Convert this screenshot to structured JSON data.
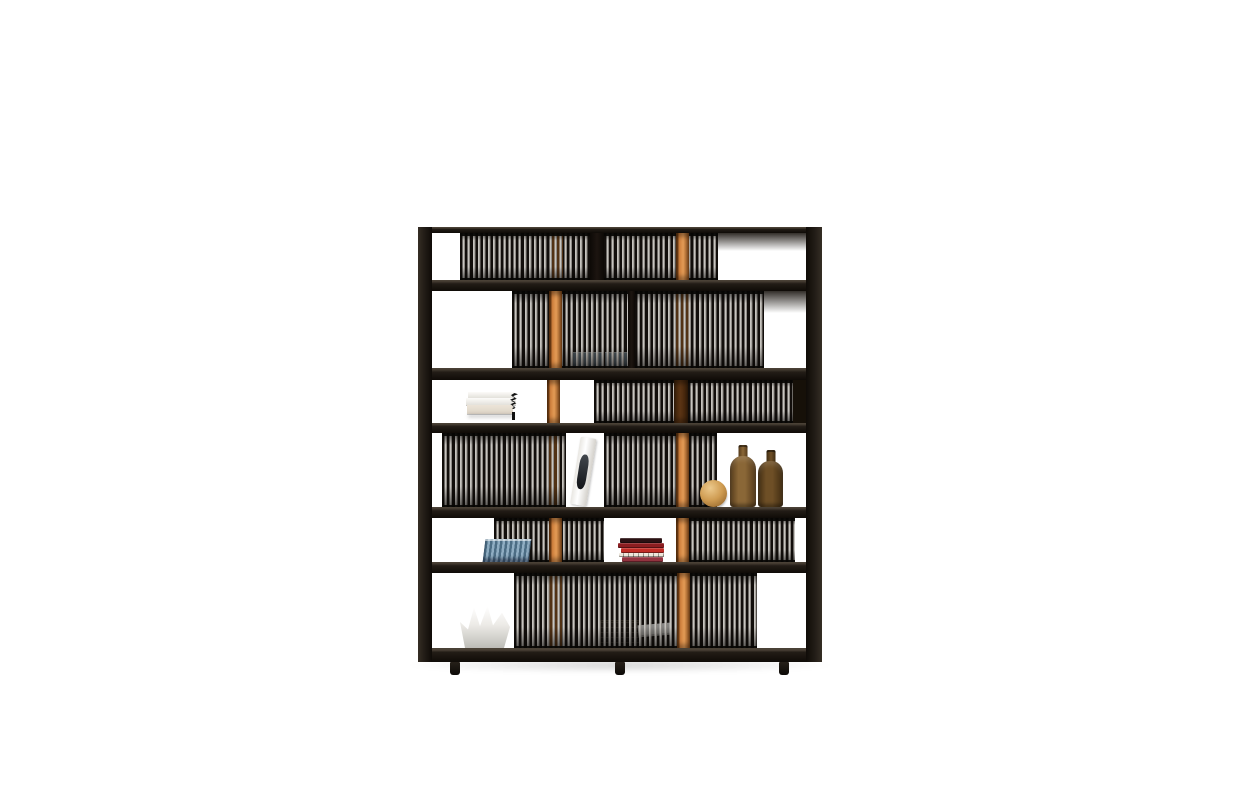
{
  "scene": {
    "description": "Product photo on a white background: tall black wooden bookshelf with six shelf rows densely filled with CDs behind thin vertical slats, two vertical orange wood accent posts running top to bottom, three small black feet, decorated with white stacked books, two translucent blue boxes, a leaning white magazine, a wooden sphere, two amber glass bottles, a stack of blue CDs, a stack of red books, a white origami-style bowl, a dark wire basket and a white paperback.",
    "background": "#ffffff"
  },
  "bookcase": {
    "rows": 6,
    "shelves": 7,
    "vertical_accent_posts": 2,
    "feet": 3
  },
  "colors": {
    "bg": "#ffffff",
    "frame": "#221c16",
    "frame_hi": "#4a4136",
    "frame_dark": "#0f0b07",
    "interior": "#1a1410",
    "rod_light": "#c7c4bf",
    "rod_mid": "#8f8b86",
    "orange": "#d0803d",
    "orange_hi": "#e29a55",
    "orange_edge": "#6f3c12",
    "orange_dim": "#9a5c24",
    "orange_shadow": "#5b3414",
    "bottle_light": "#8a6737",
    "bottle_dark": "#53391a",
    "bottle2_light": "#6e4f26",
    "bottle2_dark": "#402c12",
    "sphere": "#cf9c52",
    "sphere_hi": "#ecc98c",
    "sphere_dark": "#875821",
    "blue_light": "#8fadc2",
    "blue_dark": "#4c6d84",
    "bluebox": "#a0bccf",
    "cream": "#ece4d8"
  },
  "objects": [
    {
      "name": "stack of white books",
      "row": 3,
      "color": "#f6f5f2"
    },
    {
      "name": "pair of translucent blue boxes",
      "row": 2,
      "color": "#a0bccf"
    },
    {
      "name": "white magazine leaning against CDs",
      "row": 4,
      "color": "#f2f1ee"
    },
    {
      "name": "wooden sphere",
      "row": 4,
      "color": "#cf9c52"
    },
    {
      "name": "tall amber glass bottle",
      "row": 4,
      "color": "#8a6737"
    },
    {
      "name": "short amber glass bottle",
      "row": 4,
      "color": "#6e4f26"
    },
    {
      "name": "stack of blue CDs",
      "row": 5,
      "color": "#8fadc2"
    },
    {
      "name": "stack of red books",
      "row": 5,
      "color": "#c22c26"
    },
    {
      "name": "white origami bowl",
      "row": 6,
      "color": "#ffffff"
    },
    {
      "name": "dark wire basket",
      "row": 6,
      "color": "#17120d"
    },
    {
      "name": "white paperback",
      "row": 6,
      "color": "#fdfdfb"
    }
  ]
}
